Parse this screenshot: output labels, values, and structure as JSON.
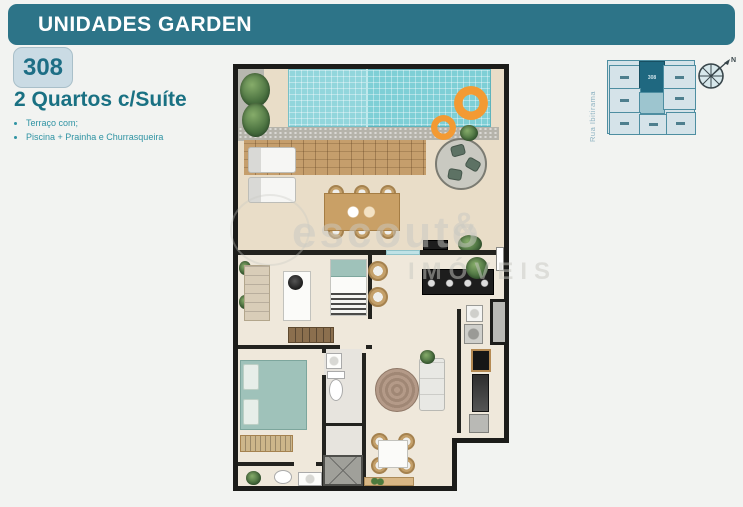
{
  "header": {
    "title": "UNIDADES GARDEN"
  },
  "unit": {
    "number": "308",
    "title": "2 Quartos c/Suíte",
    "features": [
      "Terraço com;",
      "Piscina + Prainha e Churrasqueira"
    ]
  },
  "keyplan": {
    "street": "Rua Ibitirama",
    "highlight_unit": "308",
    "compass_north": "N"
  },
  "watermark": {
    "name": "escouto",
    "amp": "&",
    "line2": "IMÓVEIS"
  },
  "colors": {
    "banner_teal": "#2d7488",
    "badge_bg": "#cadbe4",
    "headline_teal": "#1a7183",
    "bullet_teal": "#2f93a3",
    "pool_blue": "#7ecfd6",
    "float_orange": "#f39a33",
    "deck_wood": "#c59e6c",
    "plan_wall_black": "#1c1c1a",
    "keyplan_highlight": "#1f6880",
    "keyplan_cell": "#d5e3e9"
  },
  "floorplan_icons": [
    "pool-icon",
    "pool-float-icon",
    "sun-lounger-icon",
    "palm-plant-icon",
    "round-table-icon",
    "dining-table-icon",
    "barbecue-grill-icon",
    "single-bed-icon",
    "double-bed-icon",
    "desk-icon",
    "wardrobe-icon",
    "cooktop-counter-icon",
    "kitchen-sink-icon",
    "washer-icon",
    "oven-tower-icon",
    "fridge-icon",
    "toilet-icon",
    "shower-box-icon",
    "vanity-icon",
    "sofa-icon",
    "round-rug-icon",
    "small-table-icon",
    "sideboard-icon"
  ]
}
